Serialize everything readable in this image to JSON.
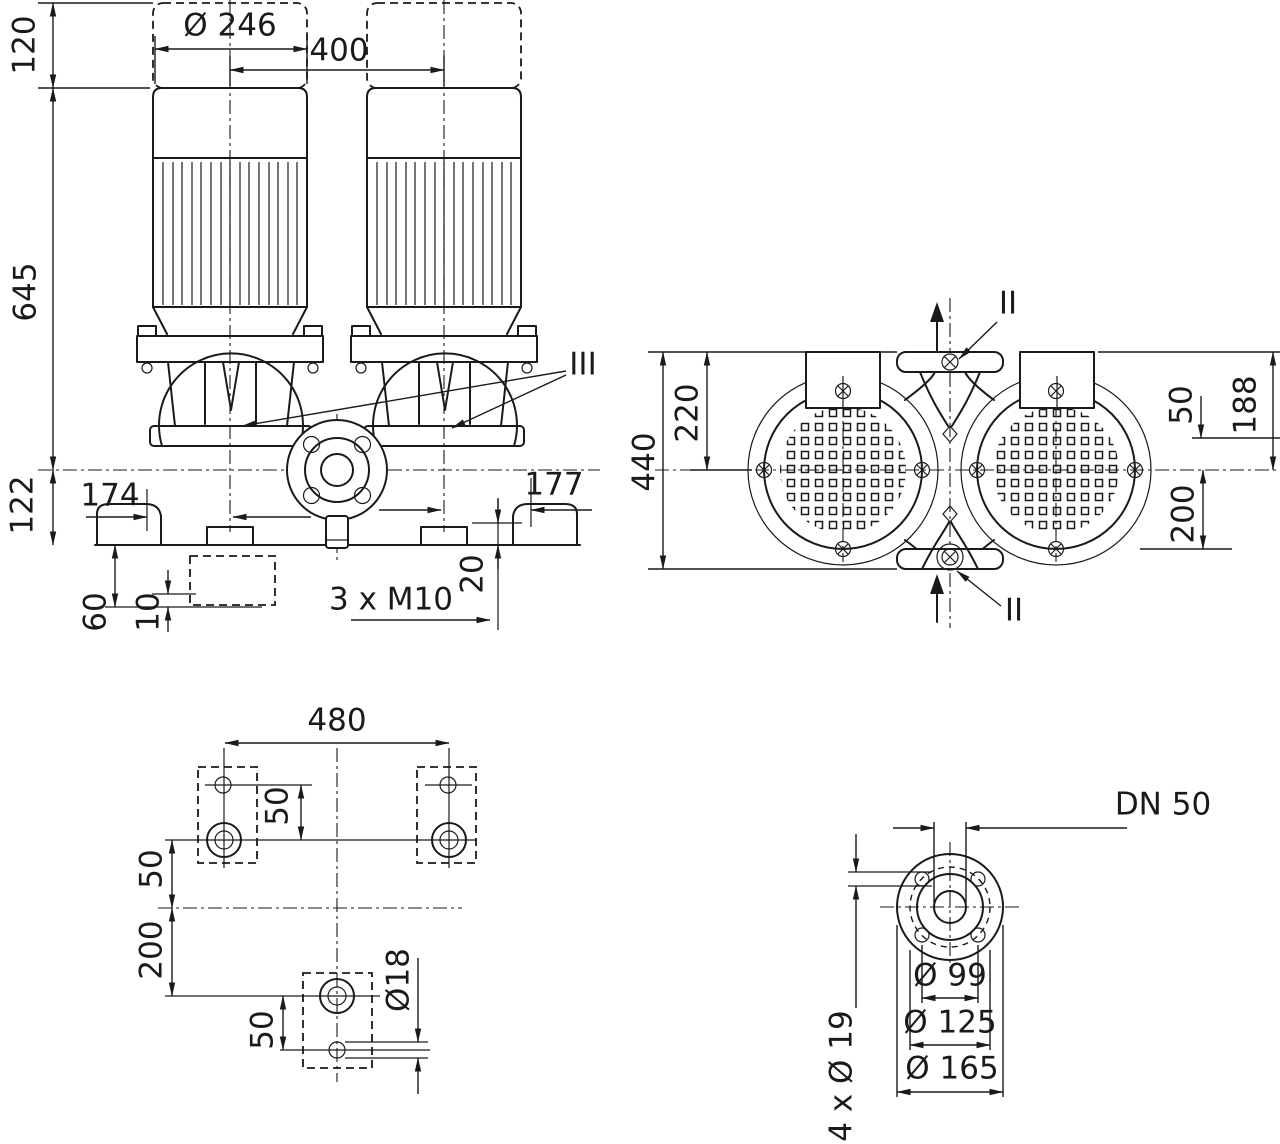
{
  "colors": {
    "ink": "#1a1a1a",
    "background": "#ffffff"
  },
  "front": {
    "d120": "120",
    "d645": "645",
    "d122": "122",
    "d246": "Ø 246",
    "d400": "400",
    "d174": "174",
    "d177": "177",
    "d20": "20",
    "dM10": "3 x M10",
    "d60": "60",
    "d10": "10",
    "marker": "III"
  },
  "top": {
    "d440": "440",
    "d220": "220",
    "d50": "50",
    "d188": "188",
    "d200": "200",
    "marker": "II"
  },
  "plan": {
    "d480": "480",
    "d50top": "50",
    "d50left": "50",
    "d200": "200",
    "d50bottom": "50",
    "d18": "Ø18"
  },
  "flange": {
    "dn": "DN 50",
    "d99": "Ø 99",
    "d125": "Ø 125",
    "d165": "Ø 165",
    "d19": "4 x Ø 19"
  }
}
